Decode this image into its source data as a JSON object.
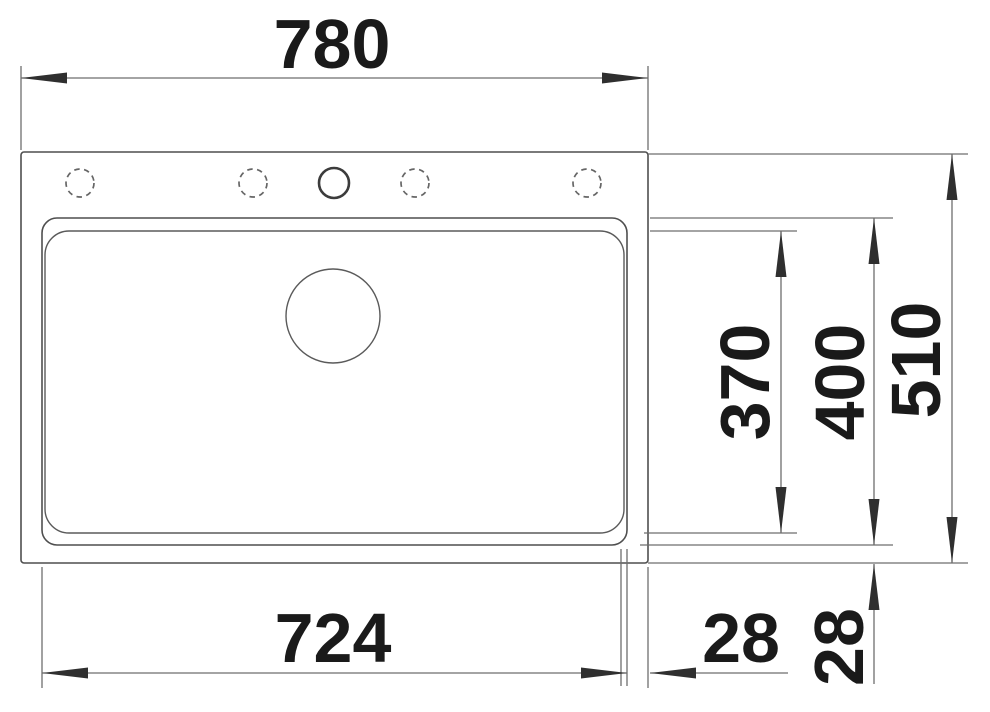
{
  "diagram": {
    "title": "sink-top-view-dimension-drawing",
    "dims": {
      "overall_width": "780",
      "bowl_width": "724",
      "right_gap": "28",
      "bottom_gap": "28",
      "inner_depth": "370",
      "bowl_depth": "400",
      "overall_depth": "510"
    },
    "features": {
      "tap_holes_dashed": 4,
      "tap_holes_solid": 1,
      "drain_circles": 1
    },
    "colors": {
      "background": "#ffffff",
      "object_line": "#4f4f4f",
      "dimension_line": "#6e6e6e",
      "label_text": "#1a1a1a"
    }
  }
}
